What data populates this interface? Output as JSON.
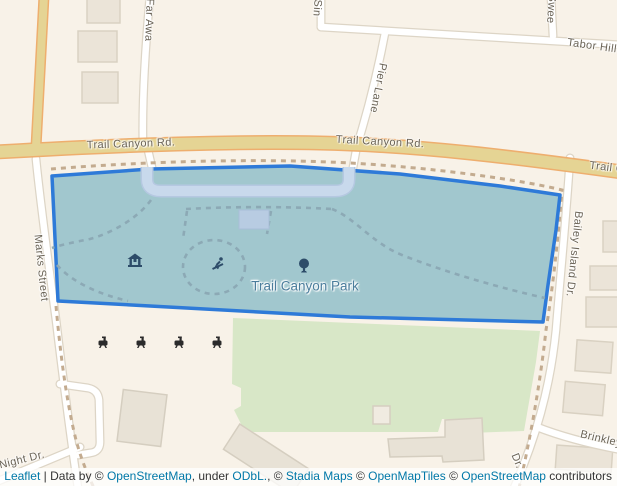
{
  "map": {
    "park_label": "Trail Canyon Park",
    "street_labels": {
      "trail_canyon_w": "Trail Canyon Rd.",
      "trail_canyon_e": "Trail Canyon Rd.",
      "trail_canyon_r": "Trail Ca",
      "far_away": "Far Awa",
      "sin": "Sin",
      "sweet": "Swee",
      "tabor_hill": "Tabor Hill",
      "pier_lane": "Pier Lane",
      "marks_street": "Marks Street",
      "bailey_island": "Bailey Island Dr.",
      "night_dr": "Night Dr.",
      "brinkley": "Brinkley",
      "dr": "Dr."
    },
    "poi_icons": {
      "picnic_shelter": "picnic-shelter-icon",
      "playground": "playground-icon",
      "tree": "tree-icon",
      "bbq_grills_count": 4
    },
    "colors": {
      "land": "#f8f2e8",
      "greenspace": "#d8e7c7",
      "water": "#c8d9ec",
      "major_road_fill": "#e5d494",
      "major_road_casing": "#eeae6e",
      "selected_area_fill": "#a1c7ce",
      "selected_area_stroke": "#2e7ad8",
      "park_label_color": "#4b7d9c",
      "link_color": "#0078a8"
    }
  },
  "attribution": {
    "leaflet": "Leaflet",
    "data_by": " | Data by © ",
    "osm1": "OpenStreetMap",
    "under": ", under ",
    "odbl": "ODbL.",
    "c1": ", © ",
    "stadia": "Stadia Maps",
    "c2": " © ",
    "openmaptiles": "OpenMapTiles",
    "c3": " © ",
    "osm2": "OpenStreetMap",
    "contributors": " contributors"
  }
}
